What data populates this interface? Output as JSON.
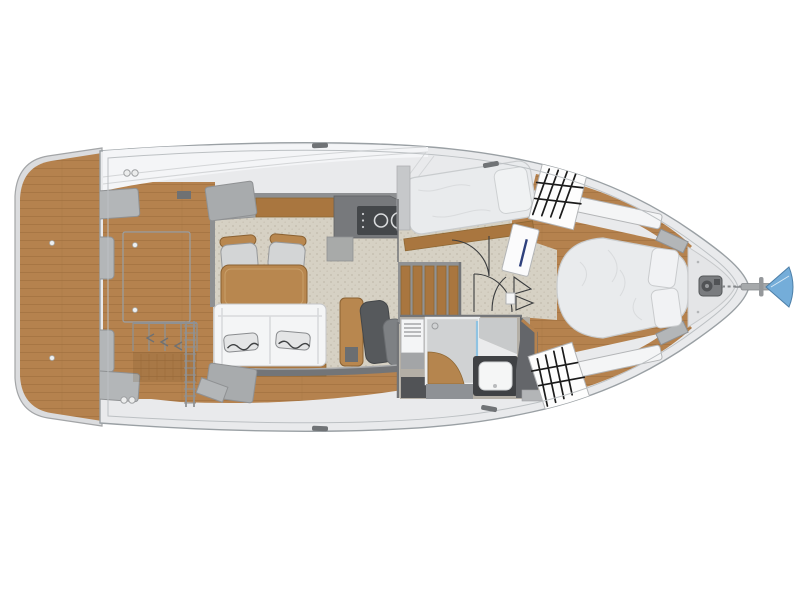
{
  "figure": {
    "title": "Motor yacht interior floor plan, top-down deck and accommodation layout",
    "type": "boat-floorplan"
  },
  "colors": {
    "page_bg": "#ffffff",
    "hull": "#e9eaec",
    "hull_outline": "#9aa0a4",
    "deck_line": "#bcc0c3",
    "roof": "#f4f5f7",
    "teak": "#b5824e",
    "teak_line": "#9a6a39",
    "cabinet_wood": "#a9763f",
    "furniture_wood": "#b8874f",
    "carpet": "#d6d1c4",
    "carpet_speckle": "#c7c1b2",
    "wall": "#737578",
    "counter": "#77797c",
    "cooktop": "#44474a",
    "mattress": "#e9ebed",
    "white_panel": "#f4f5f6",
    "seat_gray": "#b3b6b8",
    "cushion_dark": "#56595c",
    "cushion_mid": "#7e8184",
    "shower": "#d0d2d3",
    "glass": "#8fc3e2",
    "sink_counter": "#3f4144",
    "head_floor": "#b4afa6",
    "door_handle": "#2e407c",
    "anchor_fluke": "#74add9",
    "hatch_grid": "#1b1b1b"
  },
  "rooms": [
    {
      "id": "swim-platform",
      "label": "Swim platform"
    },
    {
      "id": "cockpit",
      "label": "Cockpit"
    },
    {
      "id": "saloon",
      "label": "Saloon with dinette and sofa"
    },
    {
      "id": "galley",
      "label": "Galley with two-burner cooktop"
    },
    {
      "id": "companionway",
      "label": "Companionway stairs"
    },
    {
      "id": "guest-cabin",
      "label": "Guest cabin single berth"
    },
    {
      "id": "corridor",
      "label": "Lower deck corridor"
    },
    {
      "id": "head",
      "label": "Head with shower and sink"
    },
    {
      "id": "master-cabin",
      "label": "Master cabin island berth"
    },
    {
      "id": "foredeck",
      "label": "Foredeck with windlass and anchor"
    }
  ],
  "counts": {
    "cooktop_burners": 2,
    "gridded_skylight_hatches": 2,
    "berths": 3,
    "dinette_chairs": 2,
    "sofa_pillows": 2,
    "bed_pillows": 2,
    "cockpit_transom_seats": 2
  }
}
